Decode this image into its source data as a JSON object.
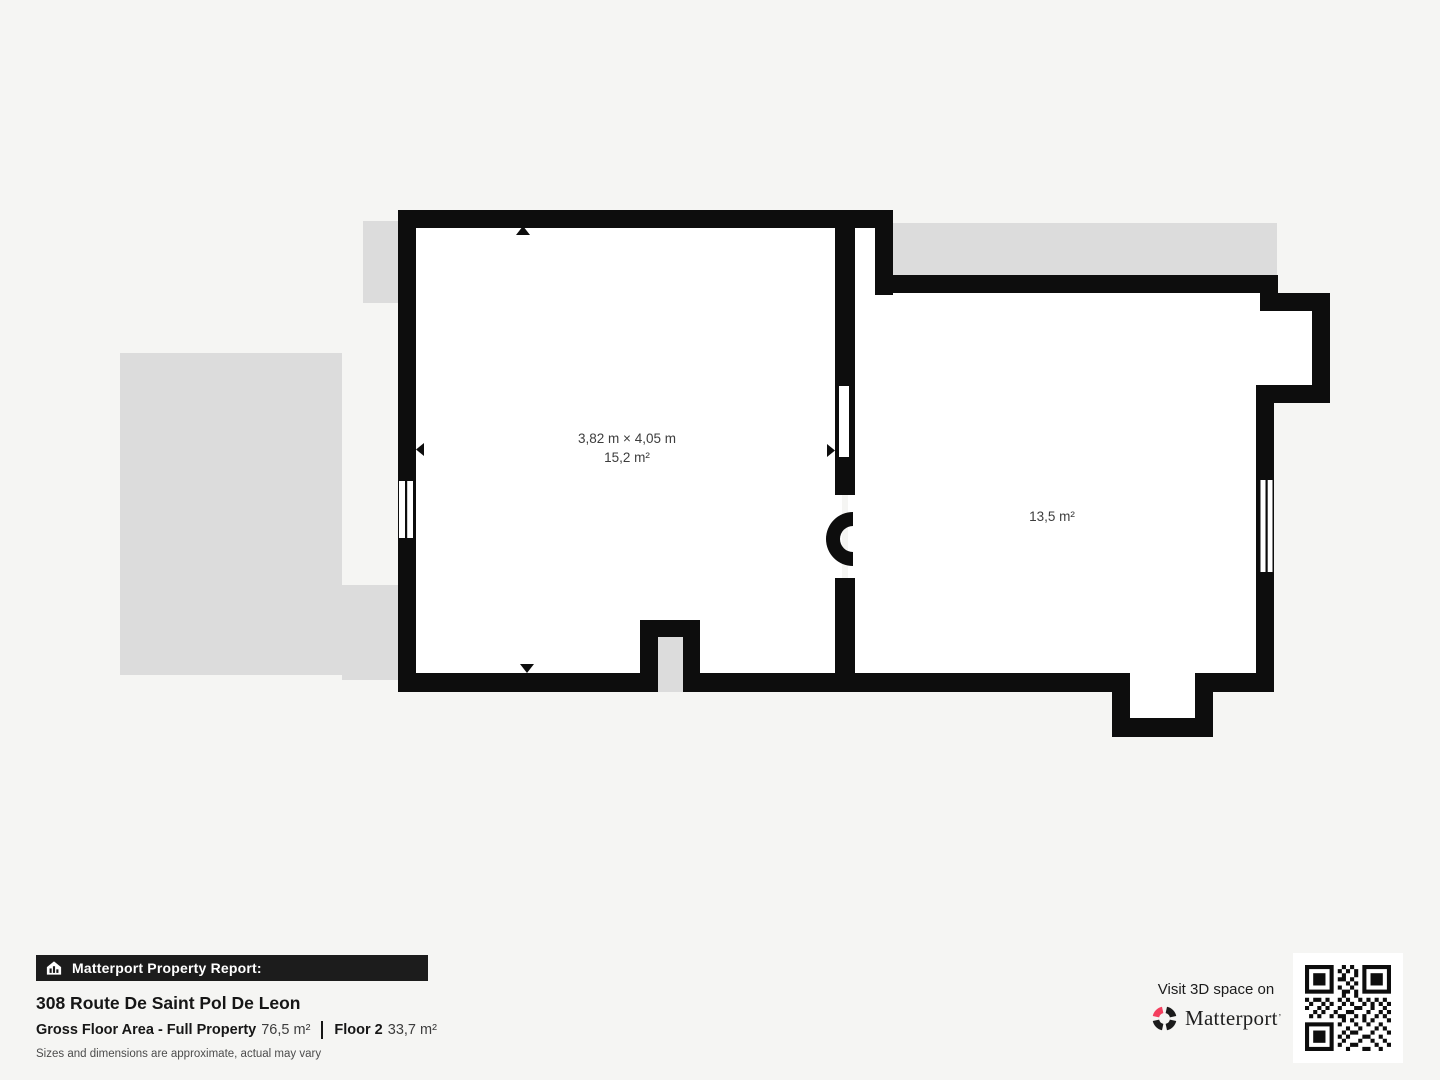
{
  "floor_plan": {
    "room_left": {
      "dimensions": "3,82 m × 4,05 m",
      "area": "15,2 m²"
    },
    "room_right": {
      "area": "13,5 m²"
    }
  },
  "footer": {
    "report_banner": "Matterport Property Report:",
    "address": "308 Route De Saint Pol De Leon",
    "gross_floor_area_label": "Gross Floor Area - Full Property",
    "gross_floor_area_value": "76,5 m²",
    "floor_label": "Floor 2",
    "floor_value": "33,7 m²",
    "disclaimer": "Sizes and dimensions are approximate, actual may vary"
  },
  "promo": {
    "visit_text": "Visit 3D space on",
    "brand": "Matterport",
    "trademark": "’"
  },
  "colors": {
    "background": "#f5f5f3",
    "wall": "#0d0d0d",
    "underlay_gray": "#dcdcdc",
    "room_white": "#ffffff",
    "banner_black": "#1c1c1c",
    "brand_red": "#f43f5e"
  }
}
